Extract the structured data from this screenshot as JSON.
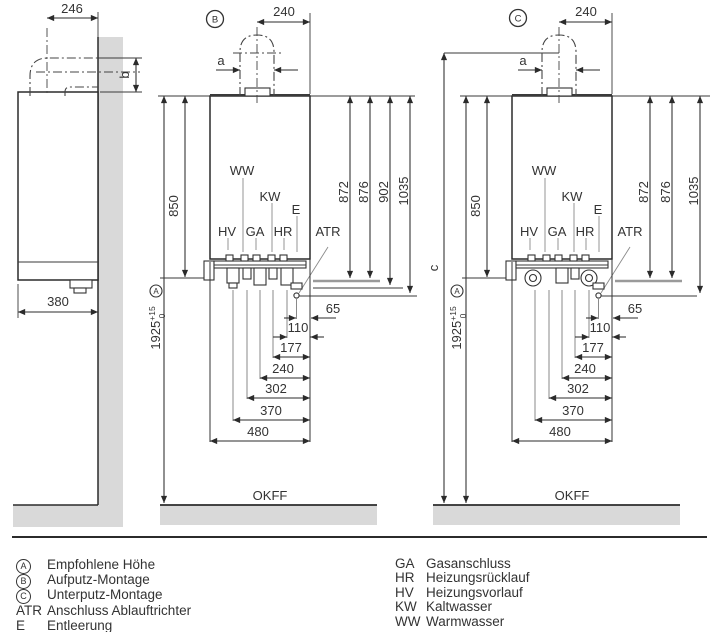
{
  "side_view": {
    "dim_width_top": "246",
    "dim_depth": "380",
    "dim_b": "b"
  },
  "front_b": {
    "badge": "B",
    "dim_flue_offset": "240",
    "dim_a": "a",
    "dim_850": "850",
    "height": {
      "value": "1925",
      "tol_plus": "+15",
      "tol_zero": "0",
      "badge": "A"
    },
    "right_dims": {
      "d872": "872",
      "d876": "876",
      "d902": "902",
      "d1035": "1035"
    },
    "connections": {
      "ww": "WW",
      "kw": "KW",
      "e": "E",
      "hv": "HV",
      "ga": "GA",
      "hr": "HR",
      "atr": "ATR"
    },
    "bottom_dims": {
      "d65": "65",
      "d110": "110",
      "d177": "177",
      "d240": "240",
      "d302": "302",
      "d370": "370",
      "d480": "480"
    },
    "floor_label": "OKFF"
  },
  "front_c": {
    "badge": "C",
    "dim_flue_offset": "240",
    "dim_a": "a",
    "dim_850": "850",
    "dim_c": "c",
    "height": {
      "value": "1925",
      "tol_plus": "+15",
      "tol_zero": "0",
      "badge": "A"
    },
    "right_dims": {
      "d872": "872",
      "d876": "876",
      "d1035": "1035"
    },
    "connections": {
      "ww": "WW",
      "kw": "KW",
      "e": "E",
      "hv": "HV",
      "ga": "GA",
      "hr": "HR",
      "atr": "ATR"
    },
    "bottom_dims": {
      "d65": "65",
      "d110": "110",
      "d177": "177",
      "d240": "240",
      "d302": "302",
      "d370": "370",
      "d480": "480"
    },
    "floor_label": "OKFF"
  },
  "legend_left": [
    {
      "key": "A",
      "label": "Empfohlene Höhe"
    },
    {
      "key": "B",
      "label": "Aufputz-Montage"
    },
    {
      "key": "C",
      "label": "Unterputz-Montage"
    },
    {
      "key": "ATR",
      "label": "Anschluss Ablauftrichter"
    },
    {
      "key": "E",
      "label": "Entleerung"
    }
  ],
  "legend_right": [
    {
      "key": "GA",
      "label": "Gasanschluss"
    },
    {
      "key": "HR",
      "label": "Heizungsrücklauf"
    },
    {
      "key": "HV",
      "label": "Heizungsvorlauf"
    },
    {
      "key": "KW",
      "label": "Kaltwasser"
    },
    {
      "key": "WW",
      "label": "Warmwasser"
    }
  ]
}
